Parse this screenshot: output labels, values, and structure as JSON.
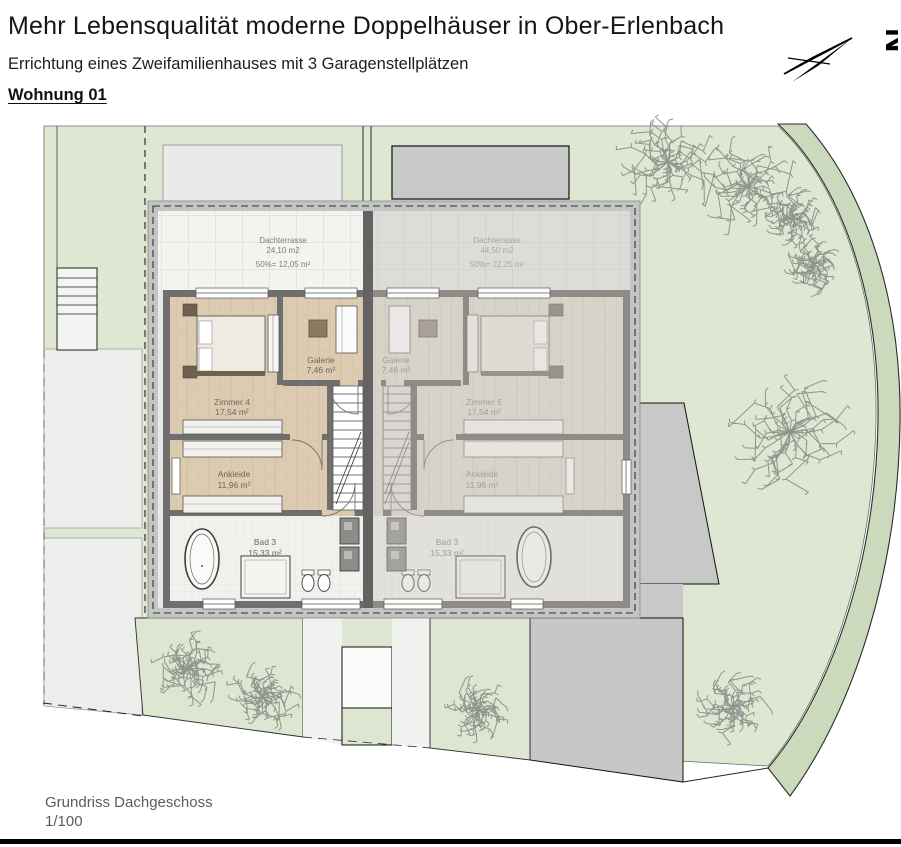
{
  "header": {
    "title": "Mehr Lebensqualität moderne Doppelhäuser in Ober-Erlenbach",
    "subtitle": "Errichtung eines Zweifamilienhauses mit 3 Garagenstellplätzen",
    "unit_label": "Wohnung 01",
    "compass_letter": "N"
  },
  "plan": {
    "left_unit": {
      "dachterrasse": {
        "label": "Dachterrasse",
        "area": "24,10 m2",
        "half_area": "50%= 12,05 m²"
      },
      "galerie": {
        "label": "Galerie",
        "area": "7,46 m²"
      },
      "zimmer": {
        "label": "Zimmer 4",
        "area": "17,54 m²"
      },
      "ankleide": {
        "label": "Ankleide",
        "area": "11,96 m²"
      },
      "bad": {
        "label": "Bad 3",
        "area": "15,33 m²"
      }
    },
    "right_unit": {
      "dachterrasse": {
        "label": "Dachterrasse",
        "area": "44,50 m2",
        "half_area": "50%= 22,25 m²"
      },
      "galerie": {
        "label": "Galerie",
        "area": "7,46 m²"
      },
      "zimmer": {
        "label": "Zimmer 5",
        "area": "17,54 m²"
      },
      "ankleide": {
        "label": "Ankleide",
        "area": "11,96 m²"
      },
      "bad": {
        "label": "Bad 3",
        "area": "15,33 m²"
      }
    }
  },
  "footer": {
    "drawing_title": "Grundriss Dachgeschoss",
    "scale": "1/100"
  },
  "colors": {
    "lawn": "#dde7d2",
    "lawn_band": "#cbd9bc",
    "wood_floor": "#dccbb0",
    "wall_dark": "#6f6f6f",
    "neighbor_gray": "#c9c9c9",
    "page_line": "#000000"
  }
}
